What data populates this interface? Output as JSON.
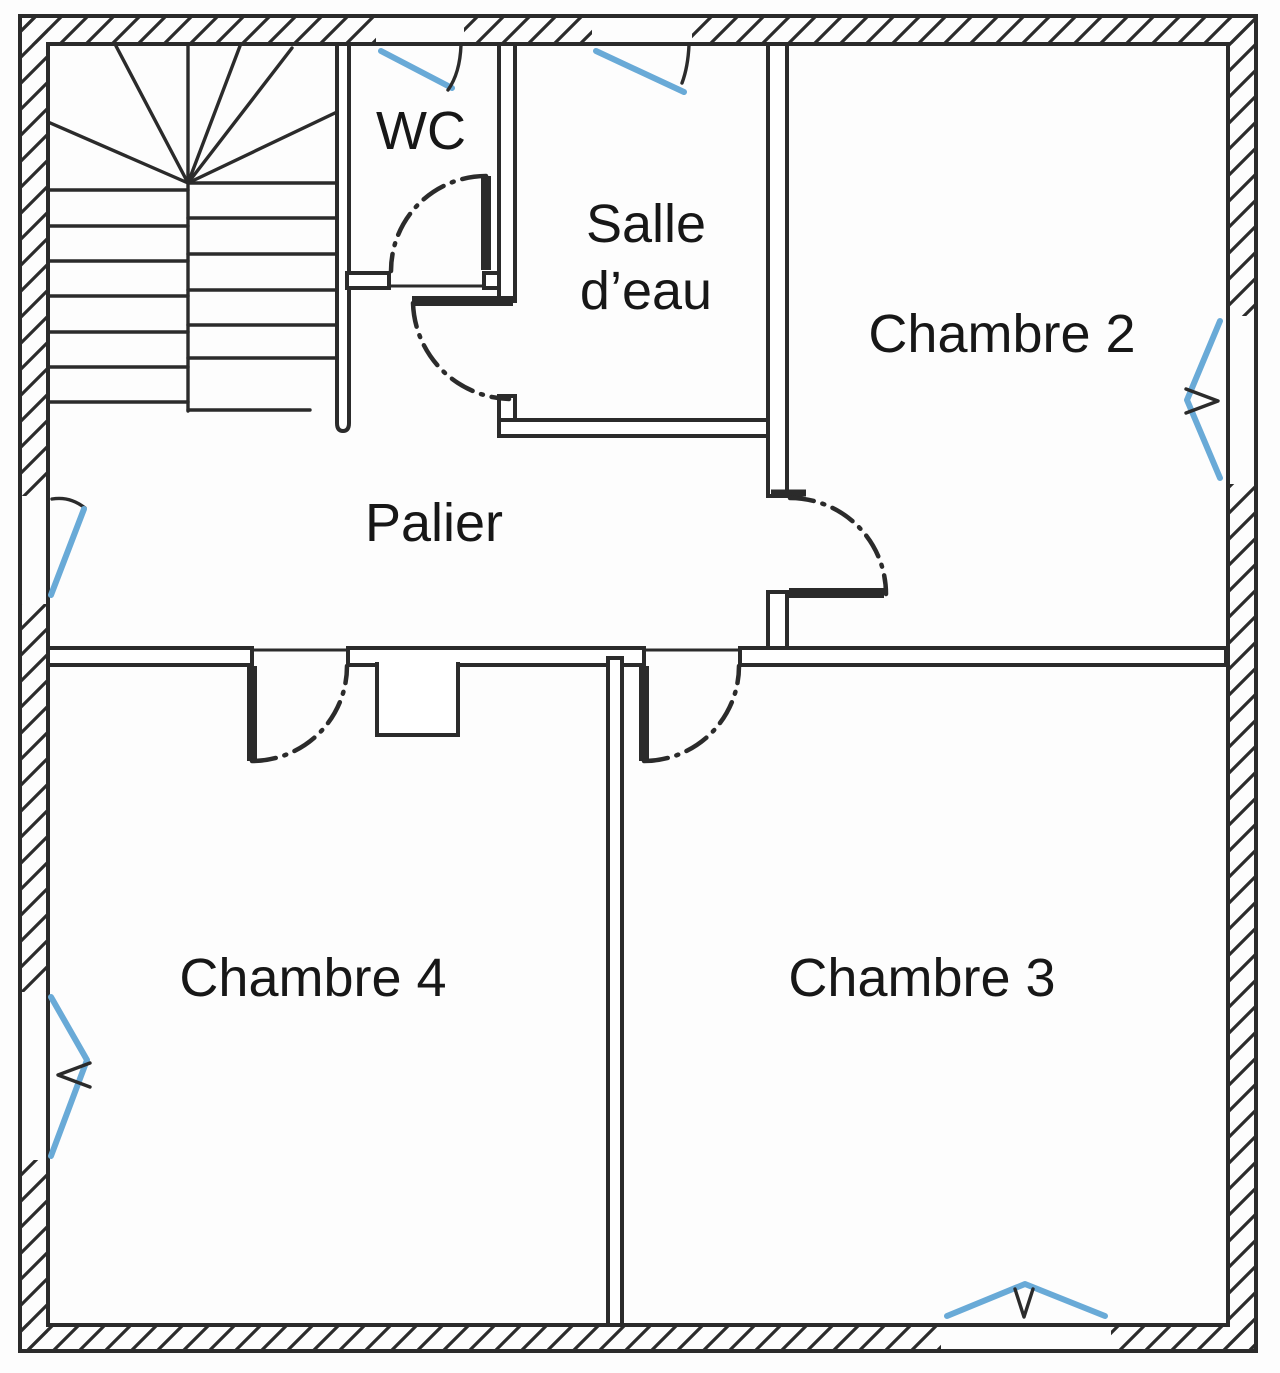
{
  "colors": {
    "paper": "#fdfdfd",
    "line": "#2b2b2b",
    "window_accent": "#69aad7",
    "label": "#171717"
  },
  "rooms": {
    "wc": {
      "label": "WC"
    },
    "salle_eau": {
      "line1": "Salle",
      "line2": "d’eau"
    },
    "chambre2": {
      "label": "Chambre 2"
    },
    "palier": {
      "label": "Palier"
    },
    "chambre4": {
      "label": "Chambre 4"
    },
    "chambre3": {
      "label": "Chambre 3"
    }
  },
  "symbols": {
    "stairs": "winder-staircase",
    "doors": [
      "wc-door",
      "salle-eau-door",
      "chambre2-door",
      "chambre4-door",
      "chambre3-door"
    ],
    "windows": [
      "wc-top-window",
      "salle-eau-top-window",
      "chambre2-right-window",
      "palier-left-window",
      "chambre4-left-window",
      "chambre3-bottom-window"
    ]
  }
}
